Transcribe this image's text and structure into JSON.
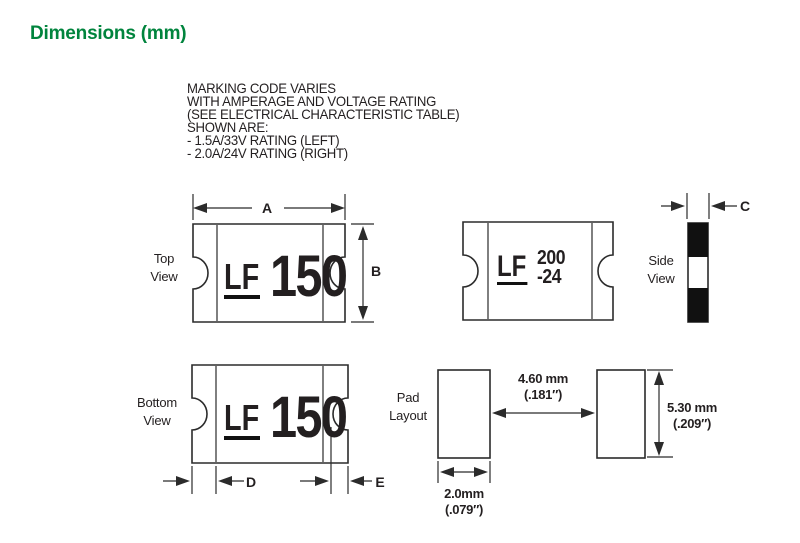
{
  "colors": {
    "accent": "#00843D",
    "ink": "#231F20",
    "line": "#2B2B2B"
  },
  "title": "Dimensions (mm)",
  "note": {
    "lines": [
      "MARKING CODE VARIES",
      "WITH AMPERAGE AND VOLTAGE RATING",
      "(SEE ELECTRICAL CHARACTERISTIC TABLE)",
      "SHOWN ARE:",
      "- 1.5A/33V RATING (LEFT)",
      "- 2.0A/24V RATING (RIGHT)"
    ]
  },
  "views": {
    "top": {
      "line1": "Top",
      "line2": "View"
    },
    "side": {
      "line1": "Side",
      "line2": "View"
    },
    "bottom": {
      "line1": "Bottom",
      "line2": "View"
    },
    "pad": {
      "line1": "Pad",
      "line2": "Layout"
    }
  },
  "markings": {
    "left_sample": {
      "logo": "LF",
      "code": "150"
    },
    "right_sample": {
      "logo": "LF",
      "code_line1": "200",
      "code_line2": "-24"
    }
  },
  "dims": {
    "a": "A",
    "b": "B",
    "c": "C",
    "d": "D",
    "e": "E",
    "pad_gap_mm": "4.60 mm",
    "pad_gap_in": "(.181″)",
    "pad_height_mm": "5.30 mm",
    "pad_height_in": "(.209″)",
    "pad_width_mm": "2.0mm",
    "pad_width_in": "(.079″)"
  }
}
